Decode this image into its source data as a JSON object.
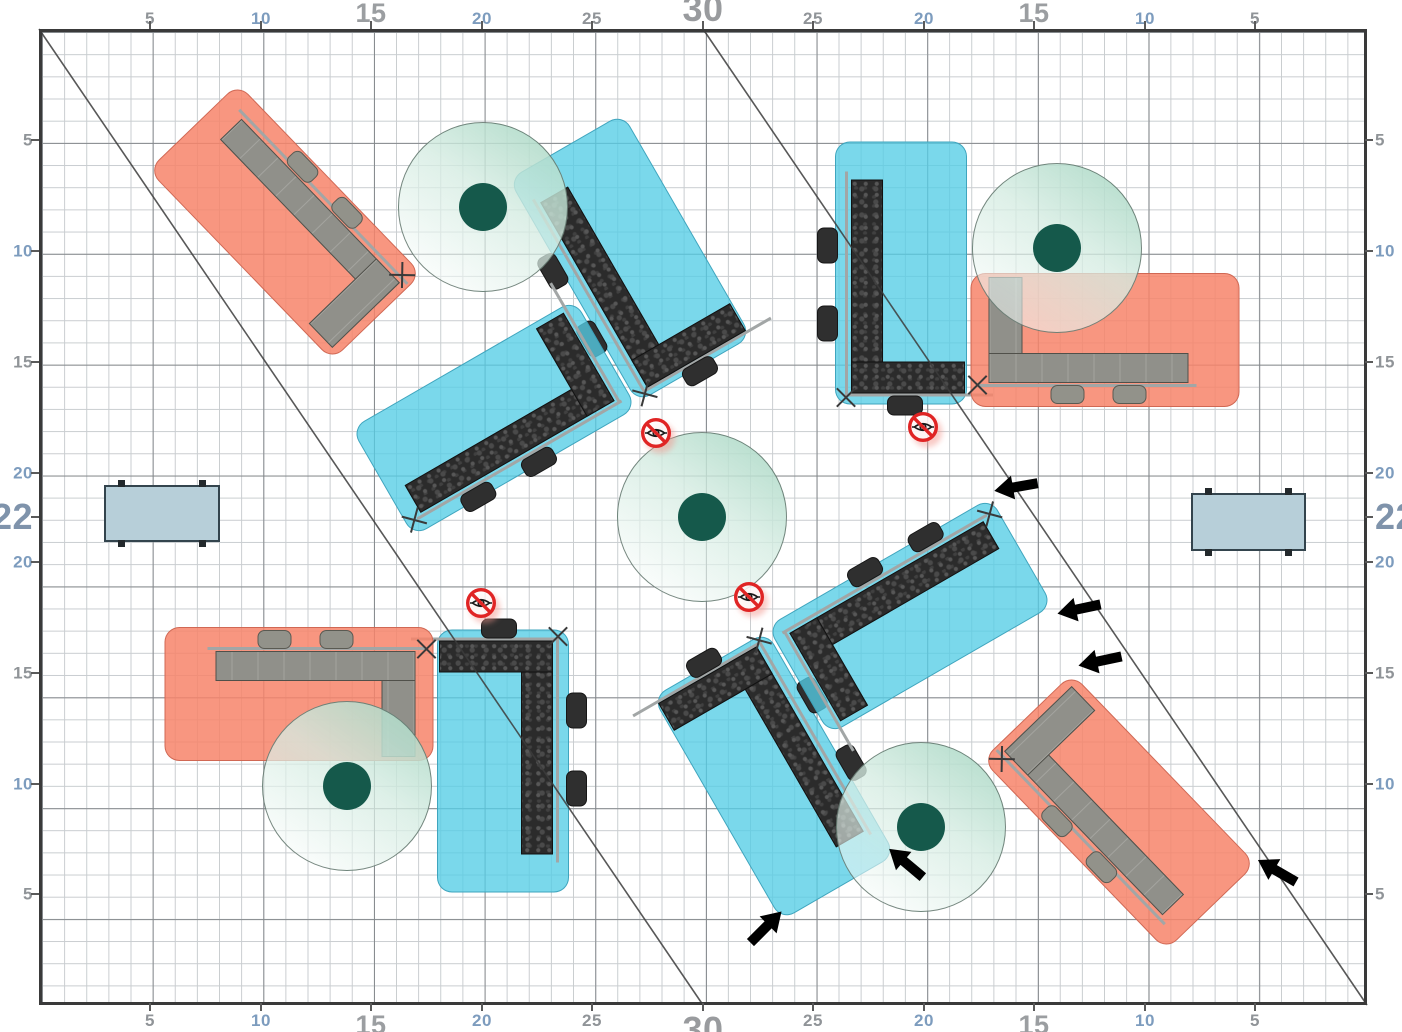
{
  "canvas": {
    "width": 1402,
    "height": 1032,
    "background": "#ffffff"
  },
  "plan": {
    "units_width": 60,
    "units_height": 44,
    "grid_minor_step_units": 1,
    "grid_major_step_units": 5,
    "border_color": "#3a3a3a",
    "grid_minor_color": "#c9cdd0",
    "grid_major_color": "#828689",
    "diagonal_lines": [
      {
        "from_units": [
          0,
          0
        ],
        "to_units": [
          30,
          44
        ]
      },
      {
        "from_units": [
          30,
          0
        ],
        "to_units": [
          60,
          44
        ]
      }
    ]
  },
  "rulers": {
    "label_colors": {
      "small_gray": "#909498",
      "small_blue": "#7d9cbe",
      "large_gray": "#9b9ea1",
      "xl_gray": "#999b9e",
      "xl_blue": "#7f93ab"
    },
    "labels": [
      {
        "side": "top",
        "text": "5",
        "x": 150,
        "y": 27,
        "cls": "g"
      },
      {
        "side": "top",
        "text": "10",
        "x": 261,
        "y": 27,
        "cls": "b"
      },
      {
        "side": "top",
        "text": "15",
        "x": 371,
        "y": 27,
        "cls": "lg"
      },
      {
        "side": "top",
        "text": "20",
        "x": 482,
        "y": 27,
        "cls": "b"
      },
      {
        "side": "top",
        "text": "25",
        "x": 592,
        "y": 27,
        "cls": "g"
      },
      {
        "side": "top",
        "text": "30",
        "x": 703,
        "y": 27,
        "cls": "xg"
      },
      {
        "side": "top",
        "text": "25",
        "x": 813,
        "y": 27,
        "cls": "g"
      },
      {
        "side": "top",
        "text": "20",
        "x": 924,
        "y": 27,
        "cls": "b"
      },
      {
        "side": "top",
        "text": "15",
        "x": 1034,
        "y": 27,
        "cls": "lg"
      },
      {
        "side": "top",
        "text": "10",
        "x": 1145,
        "y": 27,
        "cls": "b"
      },
      {
        "side": "top",
        "text": "5",
        "x": 1255,
        "y": 27,
        "cls": "g"
      },
      {
        "side": "bottom",
        "text": "5",
        "x": 150,
        "y": 1009,
        "cls": "g"
      },
      {
        "side": "bottom",
        "text": "10",
        "x": 261,
        "y": 1009,
        "cls": "b"
      },
      {
        "side": "bottom",
        "text": "15",
        "x": 371,
        "y": 1009,
        "cls": "lg"
      },
      {
        "side": "bottom",
        "text": "20",
        "x": 482,
        "y": 1009,
        "cls": "b"
      },
      {
        "side": "bottom",
        "text": "25",
        "x": 592,
        "y": 1009,
        "cls": "g"
      },
      {
        "side": "bottom",
        "text": "30",
        "x": 703,
        "y": 1009,
        "cls": "xg"
      },
      {
        "side": "bottom",
        "text": "25",
        "x": 813,
        "y": 1009,
        "cls": "g"
      },
      {
        "side": "bottom",
        "text": "20",
        "x": 924,
        "y": 1009,
        "cls": "b"
      },
      {
        "side": "bottom",
        "text": "15",
        "x": 1034,
        "y": 1009,
        "cls": "lg"
      },
      {
        "side": "bottom",
        "text": "10",
        "x": 1145,
        "y": 1009,
        "cls": "b"
      },
      {
        "side": "bottom",
        "text": "5",
        "x": 1255,
        "y": 1009,
        "cls": "g"
      },
      {
        "side": "left",
        "text": "5",
        "x": 33,
        "y": 140,
        "cls": "g"
      },
      {
        "side": "left",
        "text": "10",
        "x": 33,
        "y": 251,
        "cls": "b"
      },
      {
        "side": "left",
        "text": "15",
        "x": 33,
        "y": 362,
        "cls": "g"
      },
      {
        "side": "left",
        "text": "20",
        "x": 33,
        "y": 473,
        "cls": "b"
      },
      {
        "side": "left",
        "text": "22",
        "x": 33,
        "y": 517,
        "cls": "xb"
      },
      {
        "side": "left",
        "text": "20",
        "x": 33,
        "y": 562,
        "cls": "b"
      },
      {
        "side": "left",
        "text": "15",
        "x": 33,
        "y": 673,
        "cls": "g"
      },
      {
        "side": "left",
        "text": "10",
        "x": 33,
        "y": 784,
        "cls": "b"
      },
      {
        "side": "left",
        "text": "5",
        "x": 33,
        "y": 894,
        "cls": "g"
      },
      {
        "side": "right",
        "text": "5",
        "x": 1371,
        "y": 140,
        "cls": "g"
      },
      {
        "side": "right",
        "text": "10",
        "x": 1371,
        "y": 251,
        "cls": "b"
      },
      {
        "side": "right",
        "text": "15",
        "x": 1371,
        "y": 362,
        "cls": "g"
      },
      {
        "side": "right",
        "text": "20",
        "x": 1371,
        "y": 473,
        "cls": "b"
      },
      {
        "side": "right",
        "text": "22",
        "x": 1371,
        "y": 517,
        "cls": "xb"
      },
      {
        "side": "right",
        "text": "20",
        "x": 1371,
        "y": 562,
        "cls": "b"
      },
      {
        "side": "right",
        "text": "15",
        "x": 1371,
        "y": 673,
        "cls": "g"
      },
      {
        "side": "right",
        "text": "10",
        "x": 1371,
        "y": 784,
        "cls": "b"
      },
      {
        "side": "right",
        "text": "5",
        "x": 1371,
        "y": 894,
        "cls": "g"
      }
    ]
  },
  "objects": {
    "workstations": [
      {
        "id": "ws-top-left",
        "pad_color": "salmon",
        "desk_style": "gray",
        "center_units": [
          11.1,
          8.7
        ],
        "rotation_deg": 46,
        "desk_shape": "L desk along top edge, arm down at right, 2 chairs outside, corner cross marker"
      },
      {
        "id": "ws-bottom-right",
        "pad_color": "salmon",
        "desk_style": "gray",
        "center_units": [
          48.8,
          35.3
        ],
        "rotation_deg": 226,
        "desk_shape": "mirror of ws-top-left"
      },
      {
        "id": "ws-top-center-vertical",
        "pad_color": "cyan",
        "desk_style": "dark-textured",
        "center_units": [
          26.7,
          10.3
        ],
        "rotation_deg": -30,
        "desk_shape": "L desk bar on left, arm at bottom, 3 chairs"
      },
      {
        "id": "ws-top-center-horizontal",
        "pad_color": "cyan",
        "desk_style": "dark-textured",
        "center_units": [
          20.6,
          17.5
        ],
        "rotation_deg": -30,
        "desk_shape": "L desk bar at bottom, arm up at right, 2 chairs"
      },
      {
        "id": "ws-bottom-center-vertical",
        "pad_color": "cyan",
        "desk_style": "dark-textured",
        "center_units": [
          33.2,
          33.7
        ],
        "rotation_deg": 150,
        "desk_shape": "mirror of ws-top-center-vertical"
      },
      {
        "id": "ws-bottom-center-horizontal",
        "pad_color": "cyan",
        "desk_style": "dark-textured",
        "center_units": [
          39.4,
          26.5
        ],
        "rotation_deg": 150,
        "desk_shape": "mirror of ws-top-center-horizontal"
      },
      {
        "id": "ws-top-right-vertical",
        "pad_color": "cyan",
        "desk_style": "dark-textured",
        "center_units": [
          39.0,
          11.0
        ],
        "rotation_deg": 0,
        "desk_shape": "L desk bar on left, arm at bottom, 3 chairs"
      },
      {
        "id": "ws-top-right-horizontal",
        "pad_color": "salmon",
        "desk_style": "gray",
        "center_units": [
          48.2,
          14.0
        ],
        "rotation_deg": 0,
        "desk_shape": "L desk arm up at left, bar along bottom, 2 chairs below"
      },
      {
        "id": "ws-bottom-left-vertical",
        "pad_color": "cyan",
        "desk_style": "dark-textured",
        "center_units": [
          21.0,
          33.0
        ],
        "rotation_deg": 180,
        "desk_shape": "mirror of ws-top-right-vertical"
      },
      {
        "id": "ws-bottom-left-horizontal",
        "pad_color": "salmon",
        "desk_style": "gray",
        "center_units": [
          11.7,
          30.0
        ],
        "rotation_deg": 180,
        "desk_shape": "mirror of ws-top-right-horizontal"
      }
    ],
    "plants": [
      {
        "id": "plant-top-left",
        "center_units": [
          20.1,
          8.0
        ],
        "radius_units": 3.8
      },
      {
        "id": "plant-top-right",
        "center_units": [
          46.0,
          9.9
        ],
        "radius_units": 3.8
      },
      {
        "id": "plant-center",
        "center_units": [
          30.0,
          22.0
        ],
        "radius_units": 3.8
      },
      {
        "id": "plant-bottom-left",
        "center_units": [
          13.9,
          34.1
        ],
        "radius_units": 3.8
      },
      {
        "id": "plant-bottom-center",
        "center_units": [
          39.9,
          36.0
        ],
        "radius_units": 3.8
      }
    ],
    "side_tables": [
      {
        "id": "side-table-left",
        "center_units": [
          5.5,
          21.8
        ]
      },
      {
        "id": "side-table-right",
        "center_units": [
          54.6,
          22.1
        ]
      }
    ],
    "no_visibility_markers": [
      {
        "center_units": [
          27.9,
          18.2
        ]
      },
      {
        "center_units": [
          39.9,
          17.9
        ]
      },
      {
        "center_units": [
          20.0,
          25.9
        ]
      },
      {
        "center_units": [
          32.1,
          25.6
        ]
      }
    ],
    "red_arrows": [
      {
        "center_units": [
          44.1,
          20.6
        ],
        "points_deg": 170
      },
      {
        "center_units": [
          47.0,
          26.1
        ],
        "points_deg": 168
      },
      {
        "center_units": [
          47.9,
          28.5
        ],
        "points_deg": 168
      }
    ],
    "yellow_arrows": [
      {
        "center_units": [
          32.8,
          40.5
        ],
        "points_deg": -45
      },
      {
        "center_units": [
          39.2,
          37.6
        ],
        "points_deg": -140
      },
      {
        "center_units": [
          55.9,
          38.0
        ],
        "points_deg": -150
      }
    ]
  },
  "colors": {
    "pad_cyan": "#54cde5",
    "pad_salmon": "#f78468",
    "desk_dark": "#2b2b2b",
    "desk_gray": "#90908a",
    "plant_green": "#b7ddcc",
    "plant_dot": "#15594b",
    "side_table": "#b7cfd9",
    "arrow_red": "#e8192b",
    "arrow_yellow": "#ffe22b",
    "marker_red": "#e02424"
  }
}
